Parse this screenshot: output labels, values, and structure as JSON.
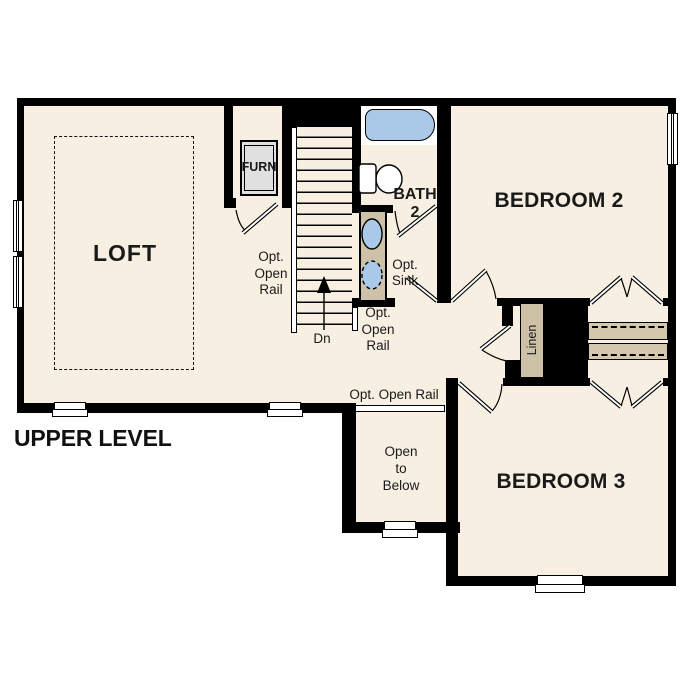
{
  "plan": {
    "title": "UPPER LEVEL",
    "rooms": {
      "loft": "LOFT",
      "bedroom2": "BEDROOM 2",
      "bedroom3": "BEDROOM 3",
      "bath_line1": "BATH",
      "bath_line2": "2",
      "furnace": "FURN",
      "linen": "Linen",
      "open_below": [
        "Open",
        "to",
        "Below"
      ]
    },
    "labels": {
      "opt_open_rail_stairs_left": [
        "Opt.",
        "Open",
        "Rail"
      ],
      "opt_open_rail_stairs_right": [
        "Opt.",
        "Open",
        "Rail"
      ],
      "opt_open_rail_bottom": "Opt. Open Rail",
      "opt_sink": [
        "Opt.",
        "Sink"
      ],
      "down": "Dn"
    },
    "colors": {
      "floor": "#f7efe2",
      "wall": "#000000",
      "fixture_tan": "#cdc1a8",
      "shelf_tan": "#d3c8ae",
      "water_blue": "#aac9e9",
      "furnace_gray": "#e0e0e0",
      "text": "#1a1a1a"
    }
  }
}
